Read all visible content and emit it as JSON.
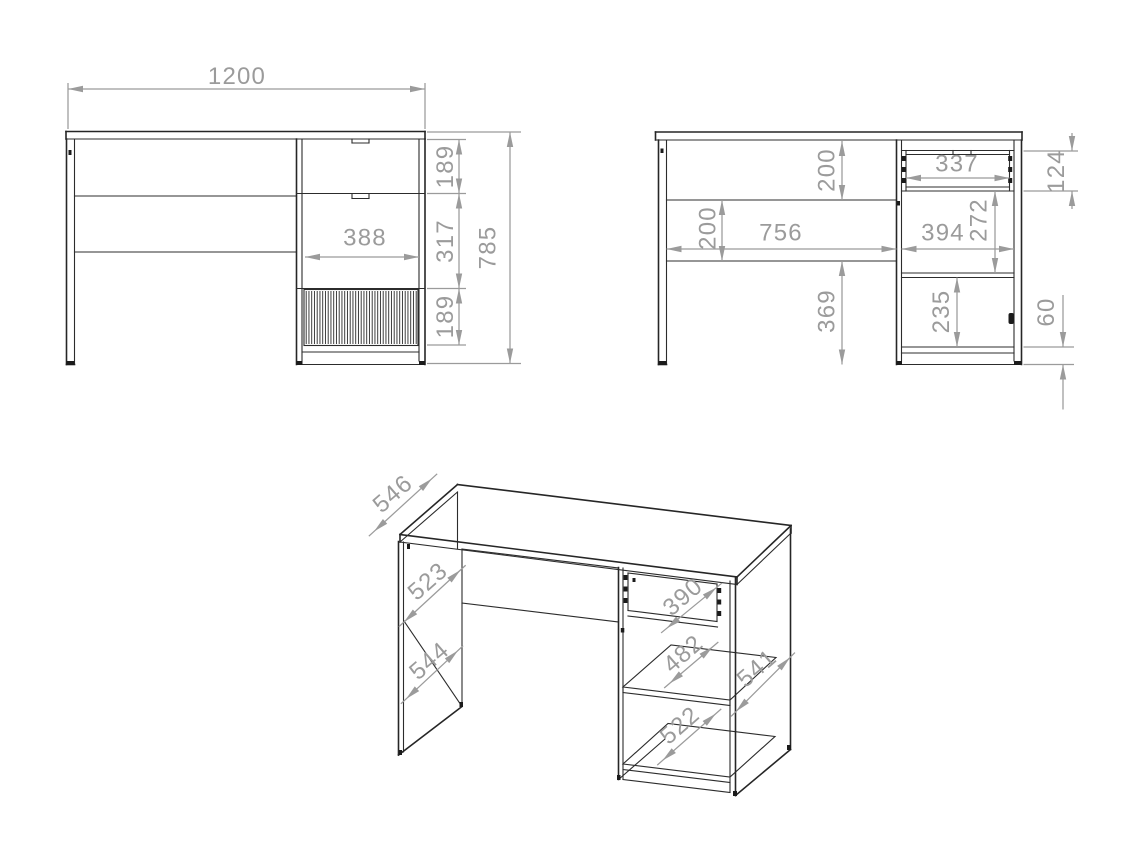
{
  "drawing": {
    "description": "furniture technical drawing - desk with drawer pedestal, three views",
    "colors": {
      "background": "#ffffff",
      "line": "#262626",
      "dimension": "#9b9b9b"
    },
    "views": {
      "front": {
        "name": "front elevation",
        "dims": {
          "width": "1200",
          "height": "785",
          "drawer_top": "189",
          "middle": "317",
          "flap": "189",
          "drawer_width": "388"
        }
      },
      "side": {
        "name": "side section",
        "dims": {
          "top_clearance": "200",
          "apron": "200",
          "knee_width": "756",
          "drawer_inner_width": "337",
          "drawer_height": "124",
          "drawer_to_shelf": "272",
          "pedestal_inner_width": "394",
          "under_apron": "369",
          "door_opening": "235",
          "plinth": "60"
        }
      },
      "iso": {
        "name": "isometric view",
        "dims": {
          "top_depth": "546",
          "inner_depth": "523",
          "panel_depth": "544",
          "drawer_depth": "390",
          "shelf_depth": "482",
          "bottom_shelf_depth": "522",
          "side_depth": "541"
        }
      }
    }
  }
}
